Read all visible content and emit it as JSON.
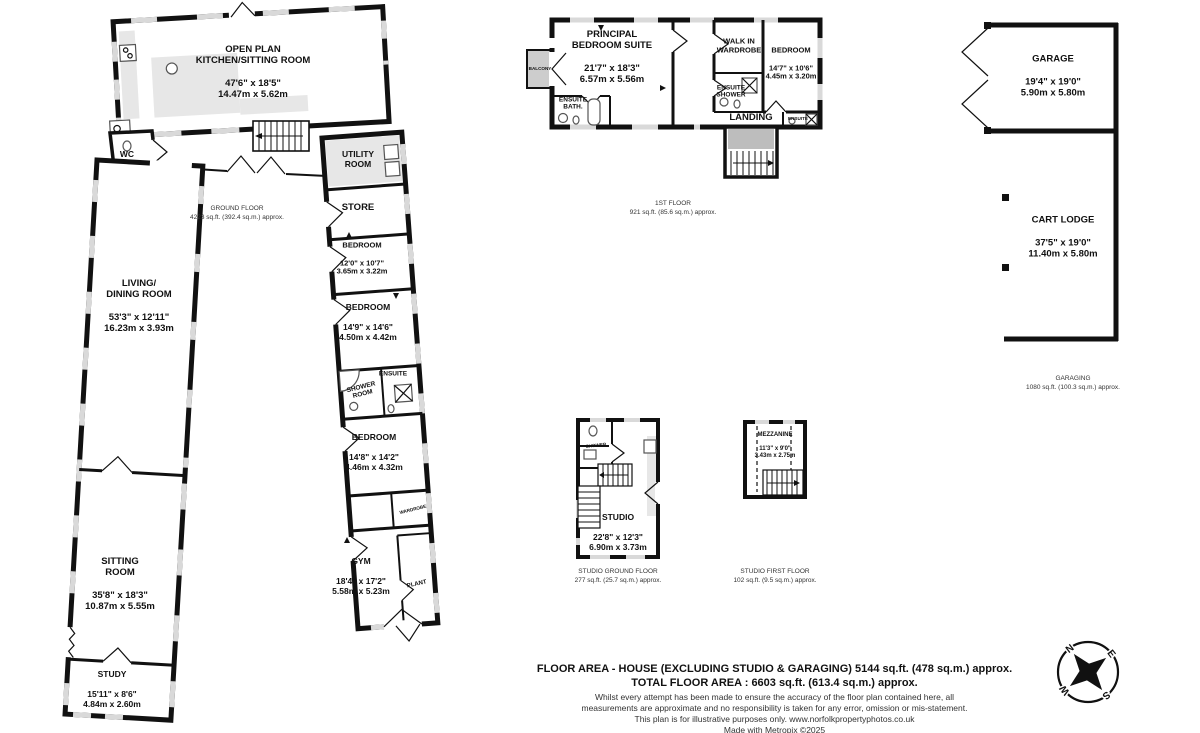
{
  "ground_floor": {
    "label": "GROUND FLOOR\n4223 sq.ft. (392.4 sq.m.) approx.",
    "rooms": {
      "kitchen": {
        "name": "OPEN PLAN\nKITCHEN/SITTING ROOM",
        "dims": "47'6\" x 18'5\"\n14.47m x 5.62m"
      },
      "wc": {
        "name": "WC"
      },
      "utility": {
        "name": "UTILITY\nROOM"
      },
      "store": {
        "name": "STORE"
      },
      "bedroom_a": {
        "name": "BEDROOM",
        "dims": "12'0\" x 10'7\"\n3.65m x 3.22m"
      },
      "bedroom_b": {
        "name": "BEDROOM",
        "dims": "14'9\" x 14'6\"\n4.50m x 4.42m"
      },
      "shower_room": {
        "name": "SHOWER\nROOM"
      },
      "ensuite": {
        "name": "ENSUITE"
      },
      "bedroom_c": {
        "name": "BEDROOM",
        "dims": "14'8\" x 14'2\"\n4.46m x 4.32m"
      },
      "wardrobe": {
        "name": "WARDROBE"
      },
      "gym": {
        "name": "GYM",
        "dims": "18'4\" x 17'2\"\n5.58m x 5.23m"
      },
      "plant": {
        "name": "PLANT"
      },
      "living_dining": {
        "name": "LIVING/\nDINING ROOM",
        "dims": "53'3\" x 12'11\"\n16.23m x 3.93m"
      },
      "sitting": {
        "name": "SITTING\nROOM",
        "dims": "35'8\" x 18'3\"\n10.87m x 5.55m"
      },
      "study": {
        "name": "STUDY",
        "dims": "15'11\" x 8'6\"\n4.84m x 2.60m"
      }
    }
  },
  "first_floor": {
    "label": "1ST FLOOR\n921 sq.ft. (85.6 sq.m.) approx.",
    "rooms": {
      "principal": {
        "name": "PRINCIPAL\nBEDROOM SUITE",
        "dims": "21'7\" x 18'3\"\n6.57m x 5.56m"
      },
      "balcony": {
        "name": "BALCONY"
      },
      "ensuite_bath": {
        "name": "ENSUITE\nBATH."
      },
      "walk_in_wardrobe": {
        "name": "WALK IN\nWARDROBE"
      },
      "ensuite_shower": {
        "name": "ENSUITE\nSHOWER"
      },
      "bedroom": {
        "name": "BEDROOM",
        "dims": "14'7\" x 10'6\"\n4.45m x 3.20m"
      },
      "landing": {
        "name": "LANDING"
      },
      "ensuite": {
        "name": "ENSUITE"
      }
    }
  },
  "garaging": {
    "label": "GARAGING\n1080 sq.ft. (100.3 sq.m.) approx.",
    "garage": {
      "name": "GARAGE",
      "dims": "19'4\" x 19'0\"\n5.90m x 5.80m"
    },
    "cart_lodge": {
      "name": "CART LODGE",
      "dims": "37'5\" x 19'0\"\n11.40m x 5.80m"
    }
  },
  "studio": {
    "ground_label": "STUDIO GROUND FLOOR\n277 sq.ft. (25.7 sq.m.) approx.",
    "first_label": "STUDIO FIRST FLOOR\n102 sq.ft. (9.5 sq.m.) approx.",
    "rooms": {
      "studio": {
        "name": "STUDIO",
        "dims": "22'8\" x 12'3\"\n6.90m x 3.73m"
      },
      "shower": {
        "name": "SHOWER"
      },
      "mezzanine": {
        "name": "MEZZANINE",
        "dims": "11'3\" x 9'0\"\n3.43m x 2.75m"
      }
    }
  },
  "footer": {
    "line1": "FLOOR AREA - HOUSE (EXCLUDING STUDIO & GARAGING) 5144 sq.ft. (478 sq.m.) approx.",
    "line2": "TOTAL FLOOR AREA : 6603 sq.ft. (613.4 sq.m.) approx.",
    "disclaimer": "Whilst every attempt has been made to ensure the accuracy of the floor plan contained here, all\nmeasurements are approximate and no responsibility is taken for any error, omission or mis-statement.\nThis plan is for illustrative purposes only. www.norfolkpropertyphotos.co.uk\nMade with Metropix ©2025"
  },
  "compass": {
    "n": "N",
    "e": "E",
    "s": "S",
    "w": "W"
  }
}
